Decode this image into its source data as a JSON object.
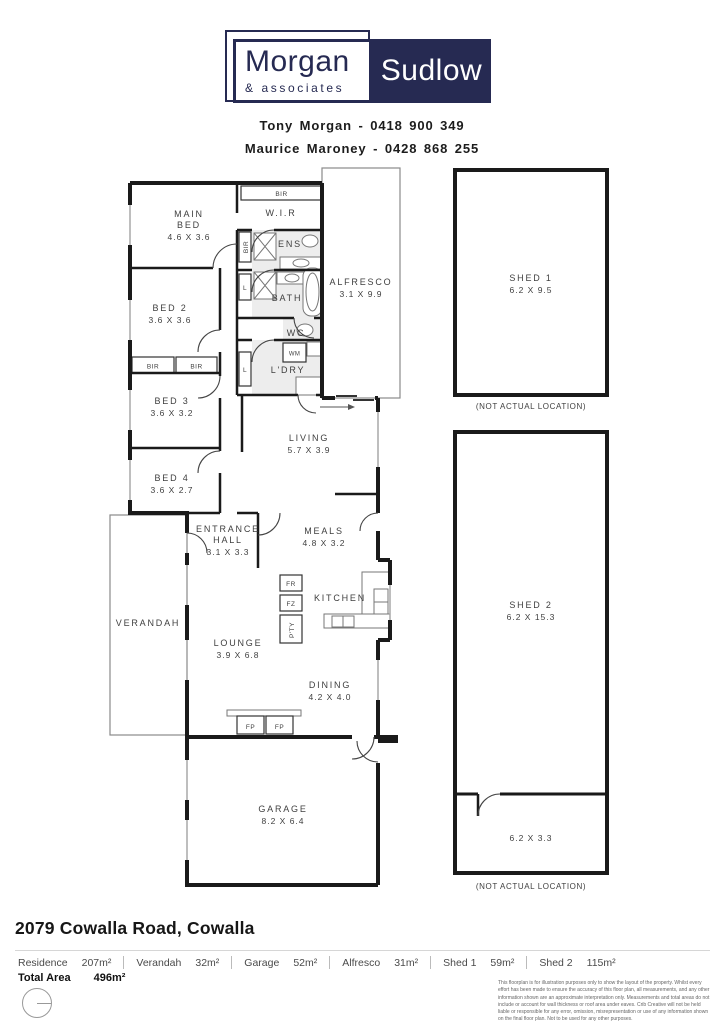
{
  "brand": {
    "morgan": "Morgan",
    "sudlow": "Sudlow",
    "associates": "& associates",
    "navy": "#262a52"
  },
  "agents": {
    "line1": "Tony Morgan - 0418 900 349",
    "line2": "Maurice Maroney - 0428 868 255"
  },
  "plan": {
    "rooms": {
      "main_bed": {
        "l1": "MAIN",
        "l2": "BED",
        "dims": "4.6 X 3.6"
      },
      "wir": {
        "l1": "W.I.R"
      },
      "ens": {
        "l1": "ENS"
      },
      "bed2": {
        "l1": "BED 2",
        "dims": "3.6 X 3.6"
      },
      "bath": {
        "l1": "BATH"
      },
      "alfresco": {
        "l1": "ALFRESCO",
        "dims": "3.1 X 9.9"
      },
      "wc": {
        "l1": "WC"
      },
      "ldry": {
        "l1": "L'DRY"
      },
      "bed3": {
        "l1": "BED 3",
        "dims": "3.6 X 3.2"
      },
      "living": {
        "l1": "LIVING",
        "dims": "5.7 X 3.9"
      },
      "bed4": {
        "l1": "BED 4",
        "dims": "3.6 X 2.7"
      },
      "hall": {
        "l1": "ENTRANCE",
        "l2": "HALL",
        "dims": "3.1 X 3.3"
      },
      "meals": {
        "l1": "MEALS",
        "dims": "4.8 X 3.2"
      },
      "kitchen": {
        "l1": "KITCHEN"
      },
      "verandah": {
        "l1": "VERANDAH"
      },
      "lounge": {
        "l1": "LOUNGE",
        "dims": "3.9 X 6.8"
      },
      "dining": {
        "l1": "DINING",
        "dims": "4.2 X 4.0"
      },
      "garage": {
        "l1": "GARAGE",
        "dims": "8.2 X 6.4"
      },
      "shed1": {
        "l1": "SHED 1",
        "dims": "6.2 X 9.5"
      },
      "shed2": {
        "l1": "SHED 2",
        "dims": "6.2 X 15.3"
      },
      "shed2_store": {
        "dims": "6.2 X 3.3"
      }
    },
    "fixtures": {
      "bir": "BIR",
      "linen": "L",
      "wm": "WM",
      "fr": "FR",
      "fz": "FZ",
      "pantry": "P'TY",
      "fp": "FP"
    },
    "captions": {
      "not_actual": "(NOT ACTUAL LOCATION)"
    }
  },
  "footer": {
    "address": "2079 Cowalla Road, Cowalla",
    "areas": [
      {
        "label": "Residence",
        "value": "207m²"
      },
      {
        "label": "Verandah",
        "value": "32m²"
      },
      {
        "label": "Garage",
        "value": "52m²"
      },
      {
        "label": "Alfresco",
        "value": "31m²"
      },
      {
        "label": "Shed 1",
        "value": "59m²"
      },
      {
        "label": "Shed 2",
        "value": "115m²"
      }
    ],
    "total_label": "Total Area",
    "total_value": "496m²",
    "disclaimer": "This floorplan is for illustration purposes only to show the layout of the property. Whilst every effort has been made to ensure the accuracy of this floor plan, all measurements, and any other information shown are an approximate interpretation only. Measurements and total areas do not include or account for wall thickness or roof area under eaves. Crib Creative will not be held liable or responsible for any error, omission, misrepresentation or use of any information shown on the final floor plan. Not to be used for any other purposes.",
    "website": "www.cribcreative.com.au"
  }
}
